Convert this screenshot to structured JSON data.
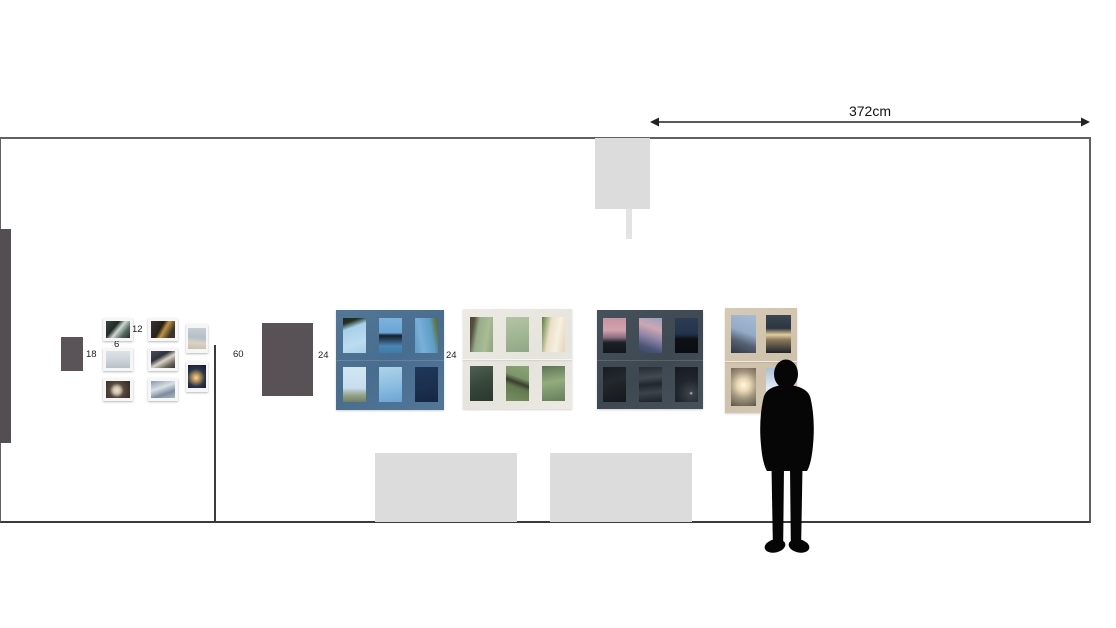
{
  "page": {
    "title": "Exhibition wall layout elevation"
  },
  "dimension": {
    "wall_width_label": "372cm"
  },
  "measurements": {
    "left_panel": "18",
    "polaroid_size": "6",
    "polaroid_block": "12",
    "cabinet": "60",
    "blue_artwork": "24",
    "cream_artwork": "24"
  },
  "colors": {
    "wall_outline": "#616161",
    "floor_line": "#3a3a3a",
    "dark_panel": "#585256",
    "sign_gray": "#dcdcdc",
    "bench_gray": "#dcdcdc",
    "blue_frame": "#4e7394",
    "cream_frame": "#e9e8e1",
    "dark_frame": "#414c55",
    "tan_frame": "#d3c6b0",
    "silhouette": "#060606"
  },
  "artworks": {
    "polaroid_grid": {
      "photo_count": 8,
      "theme": "small white-framed snapshots"
    },
    "blue_grid": {
      "photo_count": 6,
      "theme": "blue sky photographs"
    },
    "cream_grid": {
      "photo_count": 6,
      "theme": "green forest photographs"
    },
    "dark_grid": {
      "photo_count": 6,
      "theme": "dusk and night sky photographs"
    },
    "tan_grid": {
      "photo_count": 4,
      "theme": "sunrise sky photographs"
    }
  }
}
